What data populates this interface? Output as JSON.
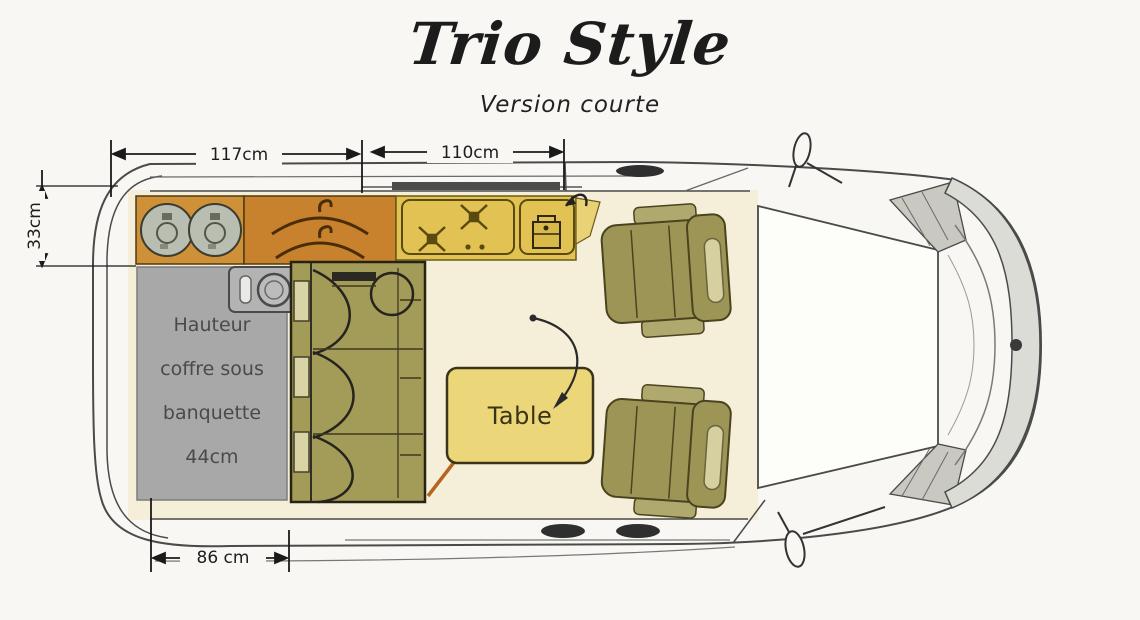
{
  "title": {
    "brand": "Trio Style",
    "subtitle": "Version courte"
  },
  "dimensions": {
    "kitchen_length": "117cm",
    "cab_length": "110cm",
    "kitchen_depth": "33cm",
    "rear_width": "86 cm"
  },
  "labels": {
    "table": "Table",
    "storage_note": {
      "lines": [
        "Hauteur",
        "coffre sous",
        "banquette",
        "44cm"
      ]
    }
  },
  "icons": {
    "gas_bottle_icon": "double-circle",
    "coat_hanger_icon": "hook-with-shoulder-arc",
    "burner_icon": "crossed-x-with-center-square",
    "coolbox_icon": "box-with-lid-handle",
    "sink_icon": "circle-bowl-with-pill-faucet",
    "swivel_arrow_icon": "curved-arrow",
    "door_open_arrow_icon": "small-curved-arrow",
    "mirror_icon": "oval-loop",
    "door_handle_icon": "dark-ellipse"
  },
  "colors": {
    "background": "#f8f7f4",
    "floor": "#f5efd9",
    "kitchen_cabinet": "#cf9137",
    "wardrobe": "#c8822e",
    "counter": "#e2c253",
    "counter_end": "#e9d276",
    "table": "#ebd67a",
    "bench": "#a39b58",
    "bench_trim": "#d9d4a5",
    "seat": "#9d9556",
    "seat_armrest": "#b0a96e",
    "seat_pad": "#d6cf9f",
    "storage_box": "#a8a8a8",
    "gas_bottle": "#b9beb3",
    "outline": "#3c3c3c"
  }
}
